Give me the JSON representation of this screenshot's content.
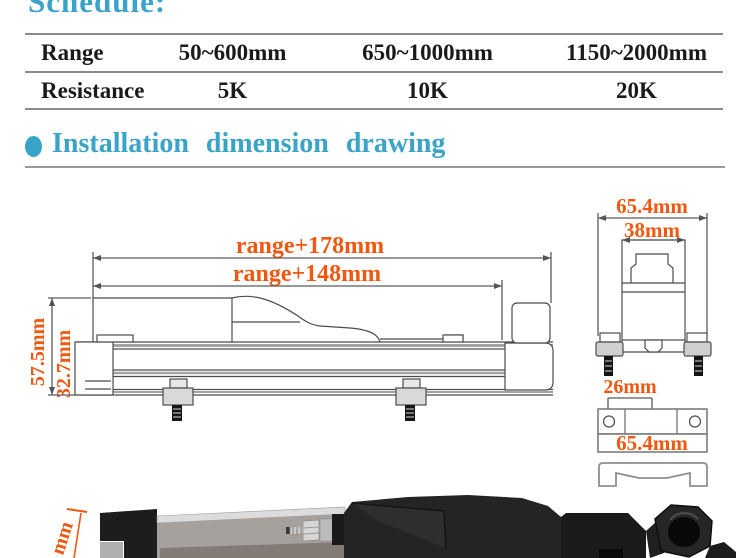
{
  "schedule": {
    "title": "Schedule:",
    "rows": [
      {
        "label": "Range",
        "values": [
          "50~600mm",
          "650~1000mm",
          "1150~2000mm"
        ]
      },
      {
        "label": "Resistance",
        "values": [
          "5K",
          "10K",
          "20K"
        ]
      }
    ]
  },
  "section": {
    "title": "Installation dimension drawing"
  },
  "drawing": {
    "side_view": {
      "length_total": "range+178mm",
      "length_body": "range+148mm",
      "height_total": "57.5mm",
      "height_rail": "32.7mm"
    },
    "end_view": {
      "width_overall": "65.4mm",
      "width_body": "38mm"
    },
    "bracket": {
      "hole_offset": "26mm",
      "length": "65.4mm"
    },
    "photo": {
      "cutoff_label": "mm"
    }
  },
  "colors": {
    "heading_cyan": "#3aa4c8",
    "dimension_orange": "#f0570f",
    "table_text": "#1a1a1a",
    "table_line": "#8a8a8a",
    "drawing_line": "#4c4c4c"
  }
}
